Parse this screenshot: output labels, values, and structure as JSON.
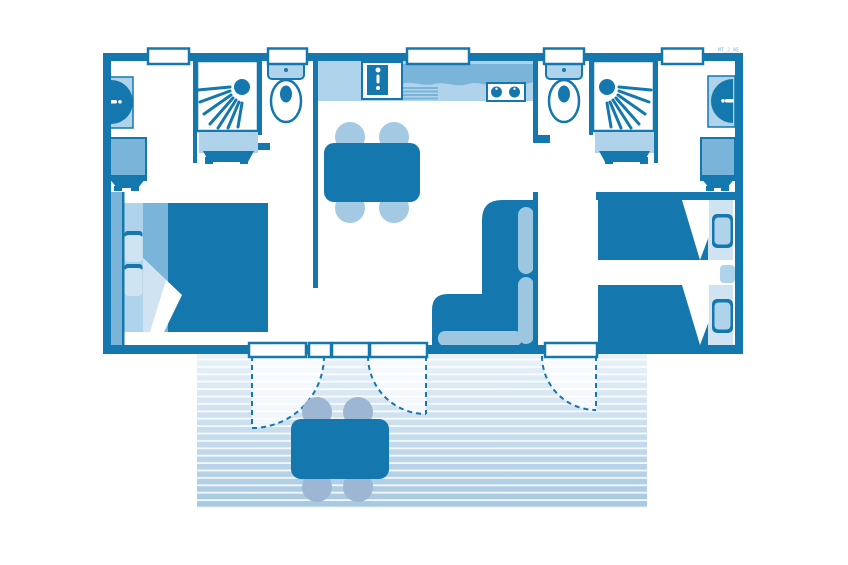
{
  "watermark": "MT_2_WE",
  "colors": {
    "dark": "#1478ae",
    "mid": "#7ab5d9",
    "light": "#aed3ea",
    "pale": "#cfe3f2",
    "cushion": "#9dc7e1",
    "chair": "#a3c9e3",
    "outdoor_chair": "#9db6d3",
    "terrace_top": "#eaf2f9",
    "terrace_bottom": "#a6c8e1",
    "watermark": "#8abfdf"
  },
  "floorplan": {
    "type": "mobile-home-2-bedroom-floor-plan",
    "rooms": [
      {
        "name": "bathroom-left",
        "furniture": [
          "wall-basin",
          "shower",
          "vanity-unit",
          "wardrobe"
        ]
      },
      {
        "name": "wc-left",
        "furniture": [
          "toilet"
        ]
      },
      {
        "name": "master-bedroom",
        "furniture": [
          "double-bed",
          "two-pillows",
          "wardrobe-strip"
        ]
      },
      {
        "name": "kitchen",
        "furniture": [
          "kitchen-sink",
          "worktop",
          "drainer",
          "hob-2-burners"
        ]
      },
      {
        "name": "living-dining",
        "furniture": [
          "dining-table",
          "four-chairs",
          "l-shaped-sofa"
        ]
      },
      {
        "name": "wc-right",
        "furniture": [
          "toilet"
        ]
      },
      {
        "name": "bathroom-right",
        "furniture": [
          "shower",
          "vanity-unit",
          "wall-basin",
          "wardrobe"
        ]
      },
      {
        "name": "twin-bedroom",
        "furniture": [
          "single-bed",
          "single-bed",
          "nightstand"
        ]
      },
      {
        "name": "terrace",
        "furniture": [
          "outdoor-table",
          "four-outdoor-chairs"
        ]
      }
    ],
    "windows_top_wall": 5,
    "terrace_doors": 3
  }
}
